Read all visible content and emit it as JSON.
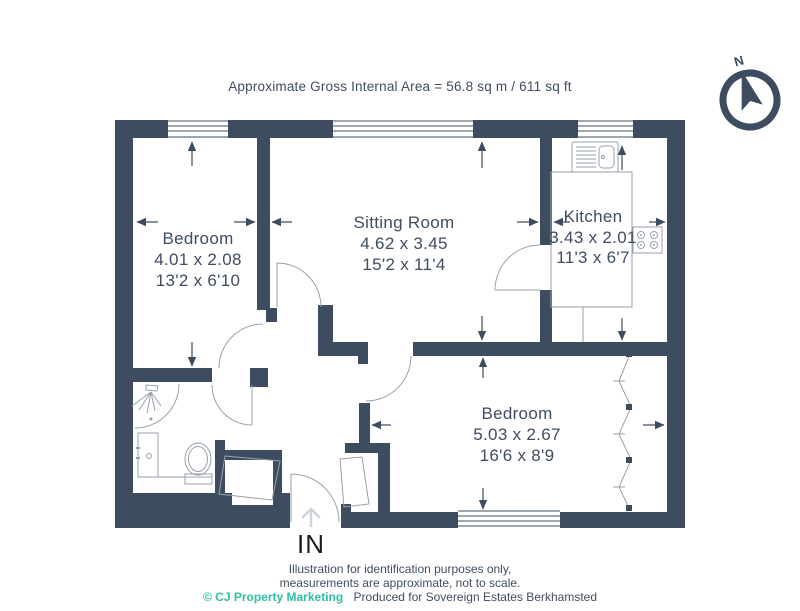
{
  "header": {
    "title": "Approximate Gross Internal Area = 56.8 sq m / 611 sq ft"
  },
  "compass": {
    "label": "N",
    "icon": "north-compass-arrow"
  },
  "floor_plan": {
    "rooms": [
      {
        "name": "Bedroom",
        "metric": "4.01 x 2.08",
        "imperial": "13'2 x 6'10"
      },
      {
        "name": "Sitting Room",
        "metric": "4.62 x 3.45",
        "imperial": "15'2 x 11'4"
      },
      {
        "name": "Kitchen",
        "metric": "3.43 x 2.01",
        "imperial": "11'3 x 6'7"
      },
      {
        "name": "Bedroom",
        "metric": "5.03 x 2.67",
        "imperial": "16'6 x 8'9"
      }
    ],
    "entrance": {
      "label": "IN",
      "icon": "chevron-up-arrow"
    },
    "fixtures": [
      "kitchen-sink",
      "hob",
      "kitchen-counter",
      "shower",
      "bath-vanity",
      "toilet",
      "wardrobe",
      "storage-cupboard",
      "storage-cupboard"
    ]
  },
  "footer": {
    "line1": "Illustration for identification purposes only,",
    "line2": "measurements are approximate, not to scale.",
    "copyright": "© CJ Property Marketing",
    "produced": "Produced for Sovereign Estates Berkhamsted"
  },
  "colors": {
    "wall": "#3d4c5f",
    "text": "#3e4d61",
    "accent_teal": "#2fc0a4",
    "fixture_line": "#97a1ad",
    "entrance_arrow_gray": "#cdd4d9",
    "in_label": "#1d1d1f"
  }
}
